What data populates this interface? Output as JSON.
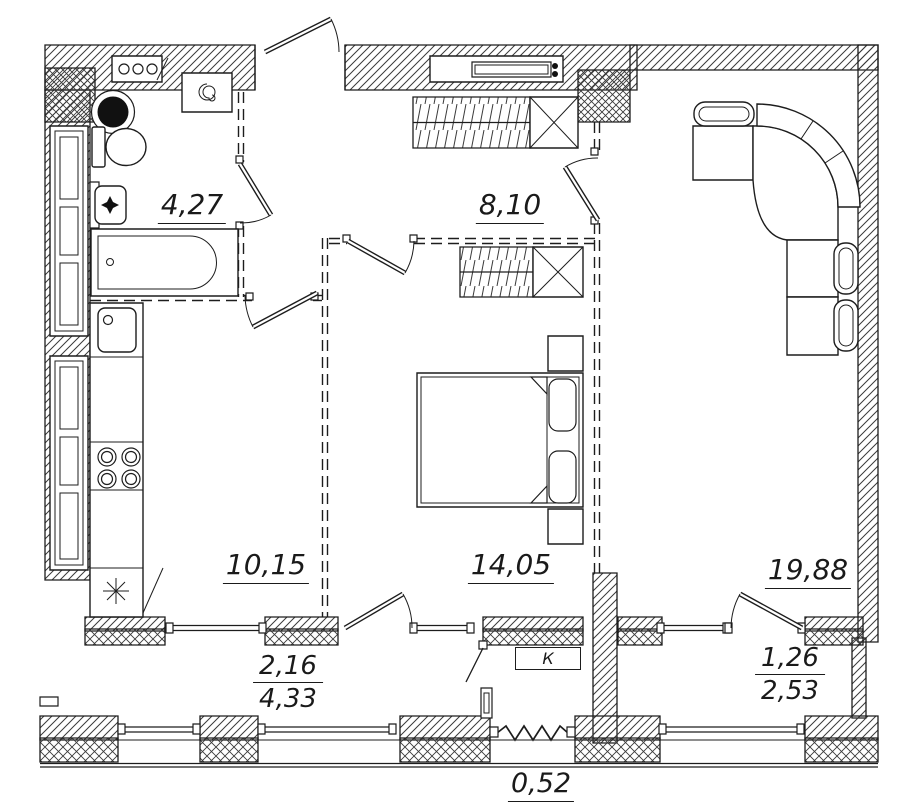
{
  "plan": {
    "rooms": {
      "bathroom": "4,27",
      "hallway": "8,10",
      "kitchen": "10,15",
      "bedroom": "14,05",
      "living": "19,88"
    },
    "balconies": {
      "left": {
        "num": "2,16",
        "den": "4,33"
      },
      "right": {
        "num": "1,26",
        "den": "2,53"
      },
      "small": "0,52"
    },
    "marks": {
      "ac_unit": "К"
    },
    "colors": {
      "line": "#1d1d1d",
      "background": "#ffffff"
    }
  }
}
